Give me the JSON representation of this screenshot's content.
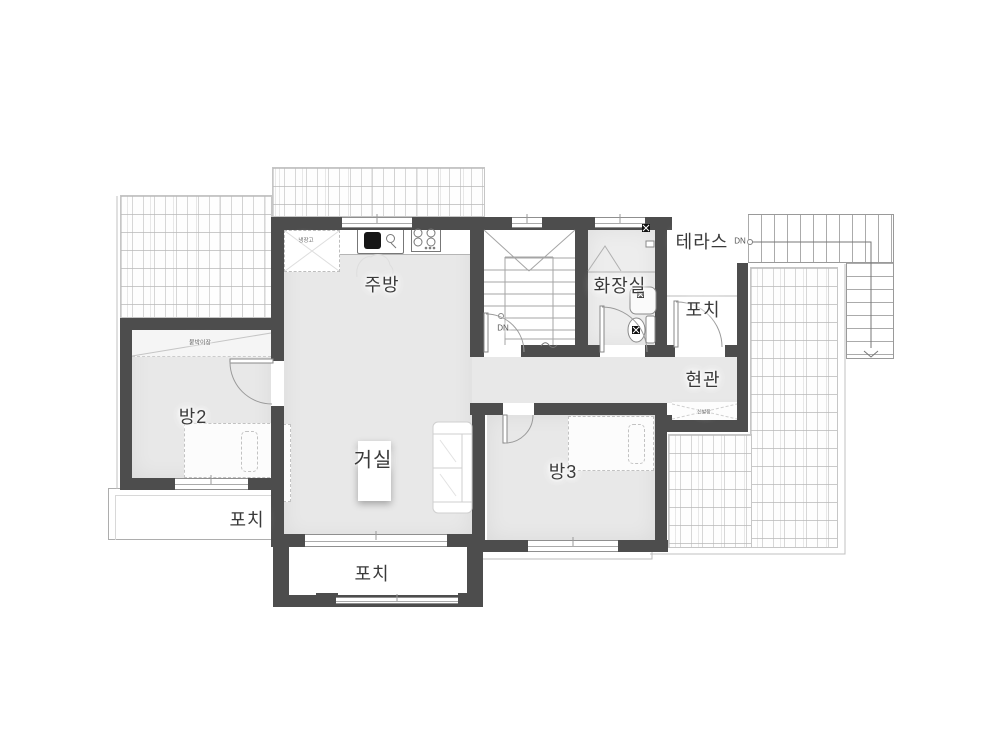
{
  "labels": {
    "kitchen": "주방",
    "bathroom": "화장실",
    "terrace": "테라스",
    "porch_right": "포치",
    "entrance": "현관",
    "shoe_cabinet": "신발장",
    "room2": "방2",
    "closet": "붙박이장",
    "living_room": "거실",
    "room3": "방3",
    "porch_left": "포치",
    "porch_bottom": "포치",
    "stair_down": "DN",
    "terrace_stair_down": "DN",
    "refrigerator": "냉장고"
  },
  "colors": {
    "wall": "#4d4d4d",
    "floor": "#e8e8e8",
    "bath_floor": "#ededed",
    "line": "#999999",
    "label_text": "#3a3a3a",
    "background": "#ffffff"
  },
  "fixtures": [
    "kitchen-sink",
    "cooktop-4-burner",
    "refrigerator-space",
    "range-hood",
    "shower",
    "wash-basin",
    "toilet",
    "floor-drain",
    "bed",
    "sofa",
    "living-table",
    "tv-cabinet",
    "interior-stairs-down",
    "exterior-stairs-down",
    "door-swing",
    "window",
    "roof-shingles"
  ]
}
